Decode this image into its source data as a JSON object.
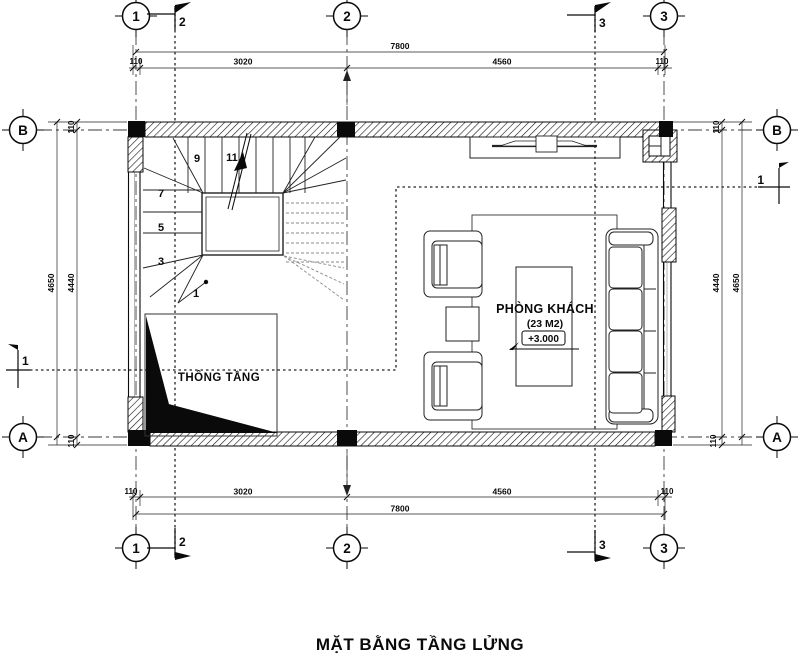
{
  "title": "MẶT BẰNG TẦNG LỬNG",
  "grid": {
    "col_1": "1",
    "col_2": "2",
    "col_3": "3",
    "row_a": "A",
    "row_b": "B"
  },
  "sections": {
    "s1": "1",
    "s2": "2",
    "s3": "3"
  },
  "dims": {
    "total_width": "7800",
    "wall_offset": "110",
    "span_left": "3020",
    "span_right": "4560",
    "total_height": "4650",
    "inner_height": "4440"
  },
  "rooms": {
    "living": {
      "name": "PHÒNG KHÁCH",
      "area": "(23 M2)",
      "level": "+3.000"
    },
    "void": {
      "name": "THÔNG TẦNG"
    }
  },
  "stairs": {
    "steps": [
      "1",
      "3",
      "5",
      "7",
      "9",
      "11"
    ]
  },
  "colors": {
    "ink": "#0a0a0a",
    "grey_tread": "#8a8a8a",
    "paper": "#ffffff"
  }
}
